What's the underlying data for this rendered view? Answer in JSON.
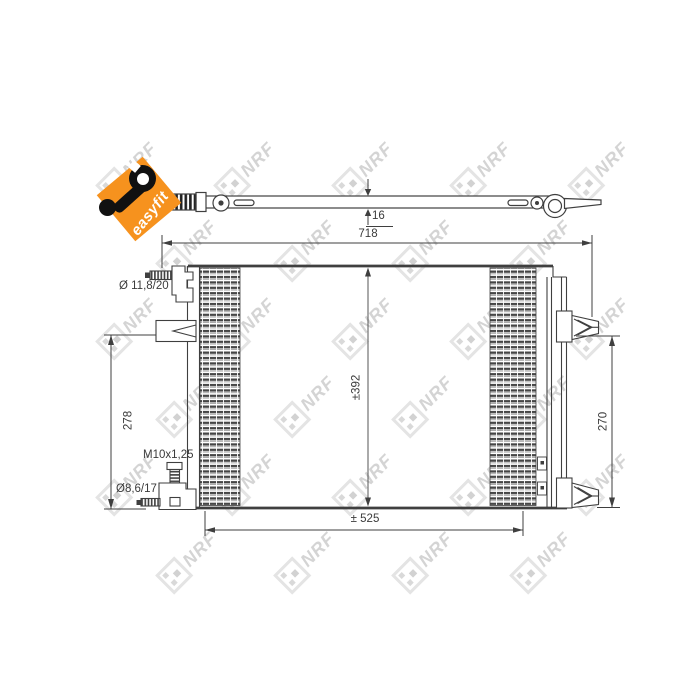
{
  "page": {
    "background": "#ffffff"
  },
  "badge": {
    "label": "easyfit",
    "color": "#f6921e"
  },
  "watermark": {
    "text": "NRF"
  },
  "diagram": {
    "type": "technical-drawing",
    "subject": "condenser-with-side-profile",
    "line_color": "#3f3f3f",
    "labels": {
      "thickness": "16",
      "overall_width": "718",
      "core_height": "±392",
      "left_mount_height": "278",
      "right_mount_height": "270",
      "bottom_width": "± 525",
      "top_port": "Ø 11,8/20",
      "thread_spec": "M10x1,25",
      "bottom_port": "Ø8,6/17"
    }
  }
}
